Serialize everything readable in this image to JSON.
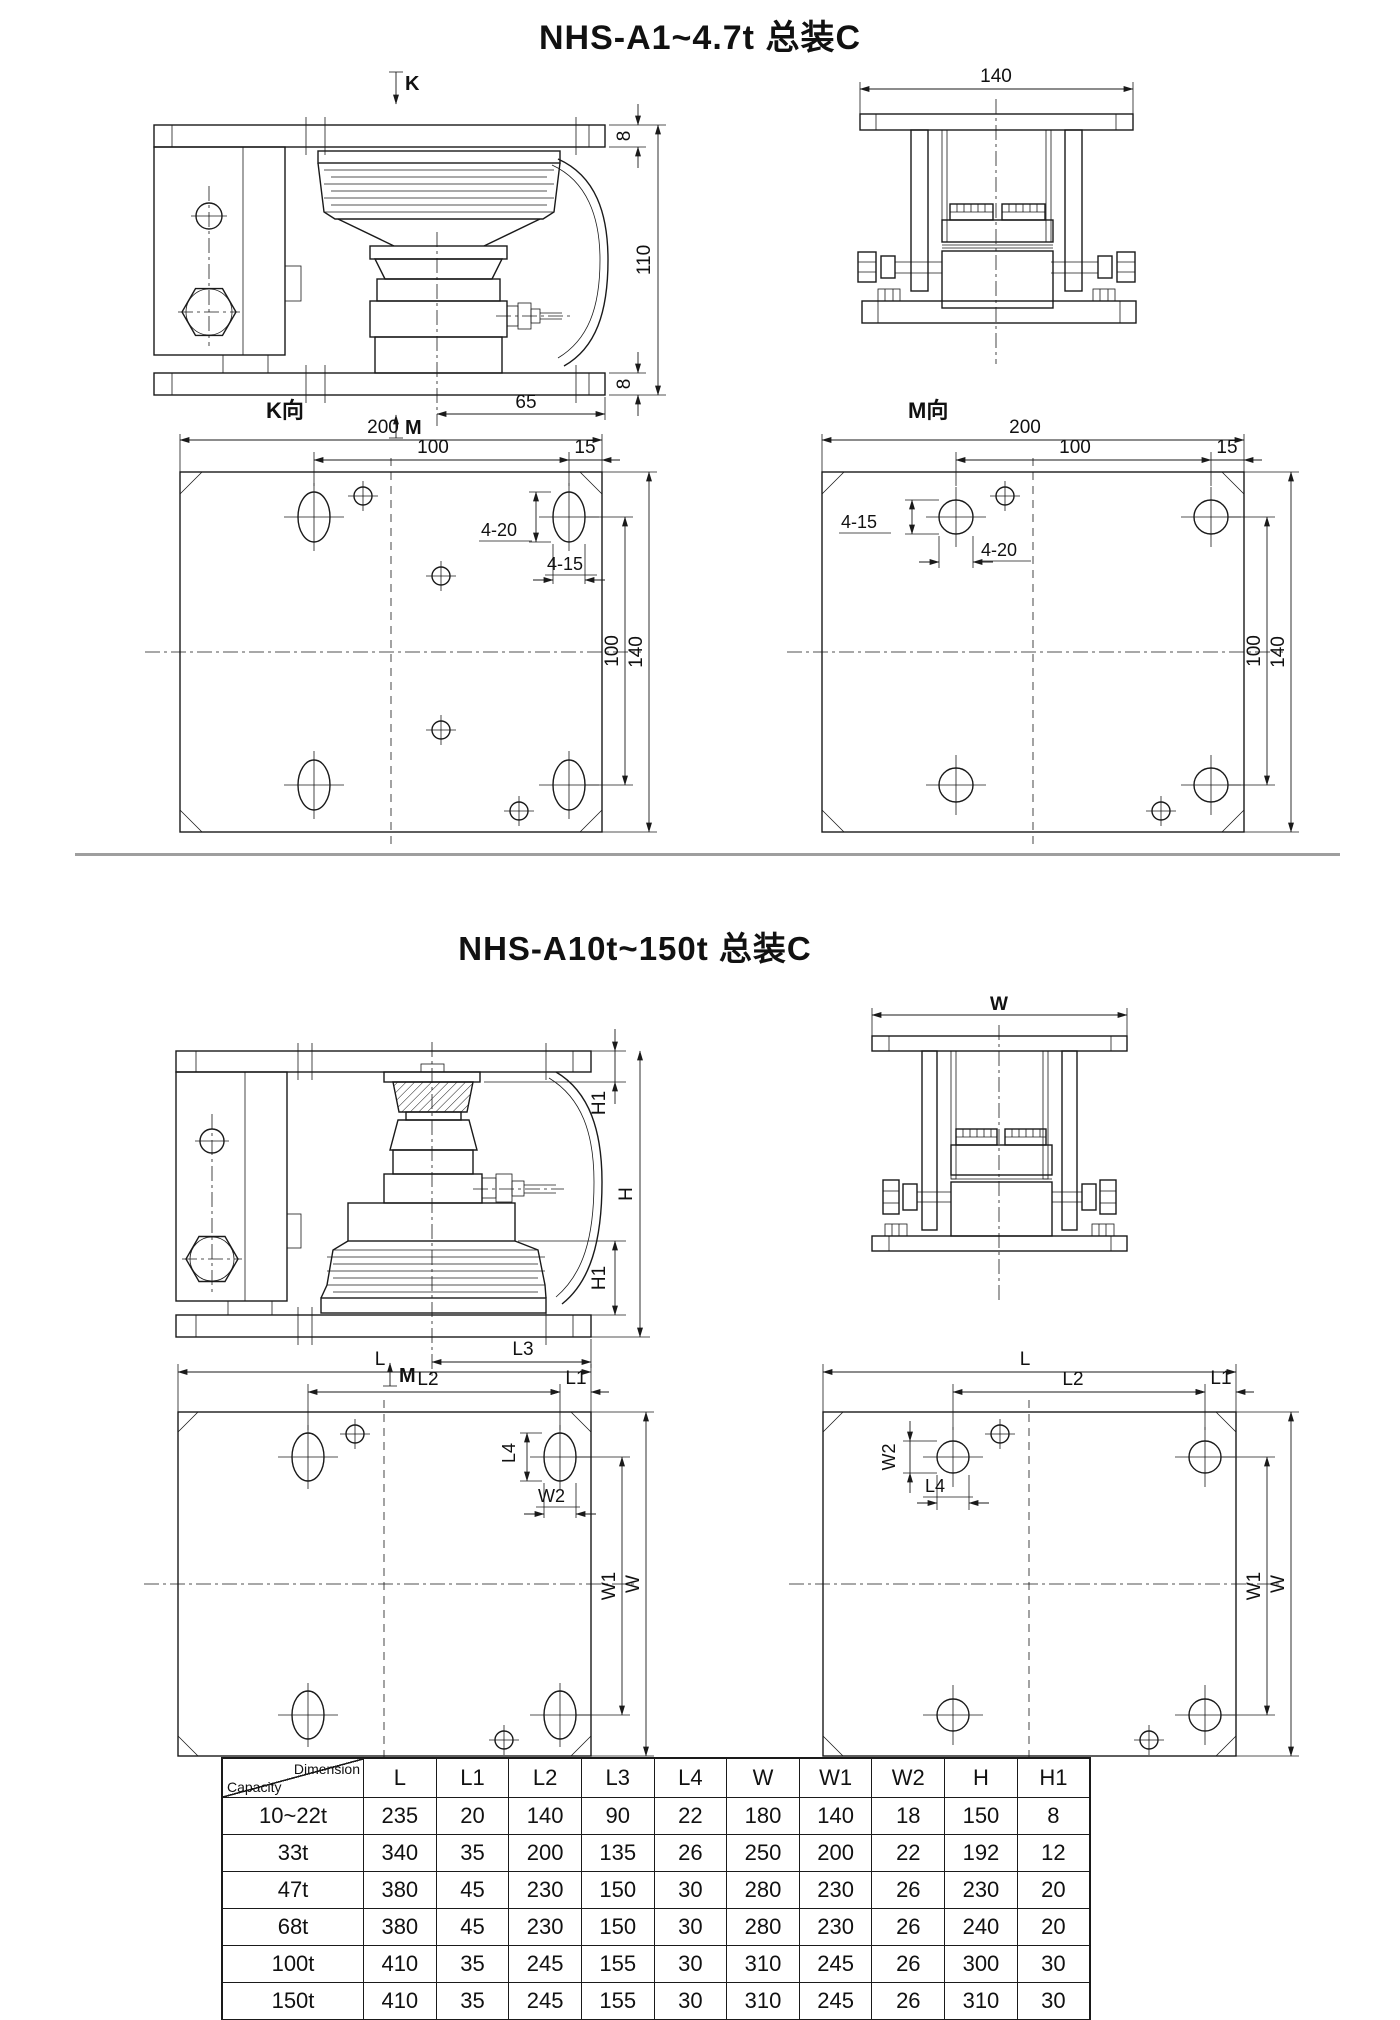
{
  "page": {
    "title1": "NHS-A1~4.7t 总装C",
    "title2": "NHS-A10t~150t 总装C",
    "line_color": "#1a1a1a",
    "divider_color": "#9e9e9e",
    "background": "#ffffff"
  },
  "section1": {
    "side_view": {
      "view_arrow_top": "K",
      "view_arrow_bottom": "M",
      "dim_plate_top": "8",
      "dim_height": "110",
      "dim_plate_bottom": "8",
      "dim_offset": "65"
    },
    "front_view": {
      "dim_width": "140"
    },
    "plan_top": {
      "label": "K向",
      "dim_width": "200",
      "dim_span": "100",
      "dim_edge": "15",
      "slot_dim": "4-20",
      "hole_dim": "4-15",
      "dim_span_v": "100",
      "dim_height": "140"
    },
    "plan_bottom": {
      "label": "M向",
      "dim_width": "200",
      "dim_span": "100",
      "dim_edge": "15",
      "hole_dim": "4-15",
      "slot_dim": "4-20",
      "dim_span_v": "100",
      "dim_height": "140"
    }
  },
  "section2": {
    "side_view": {
      "dim_h1_top": "H1",
      "dim_h": "H",
      "dim_h1_bottom": "H1",
      "dim_l3": "L3",
      "view_arrow_bottom": "M"
    },
    "front_view": {
      "dim_width": "W"
    },
    "plan_top": {
      "dim_l": "L",
      "dim_l2": "L2",
      "dim_l1": "L1",
      "dim_l4": "L4",
      "dim_w2": "W2",
      "dim_w1": "W1",
      "dim_w": "W"
    },
    "plan_bottom": {
      "dim_l": "L",
      "dim_l2": "L2",
      "dim_l1": "L1",
      "dim_w2": "W2",
      "dim_l4": "L4",
      "dim_w1": "W1",
      "dim_w": "W"
    }
  },
  "table": {
    "corner": {
      "top_right": "Dimension",
      "bottom_left": "Capacity"
    },
    "columns": [
      "L",
      "L1",
      "L2",
      "L3",
      "L4",
      "W",
      "W1",
      "W2",
      "H",
      "H1"
    ],
    "rows": [
      {
        "capacity": "10~22t",
        "values": [
          235,
          20,
          140,
          90,
          22,
          180,
          140,
          18,
          150,
          8
        ]
      },
      {
        "capacity": "33t",
        "values": [
          340,
          35,
          200,
          135,
          26,
          250,
          200,
          22,
          192,
          12
        ]
      },
      {
        "capacity": "47t",
        "values": [
          380,
          45,
          230,
          150,
          30,
          280,
          230,
          26,
          230,
          20
        ]
      },
      {
        "capacity": "68t",
        "values": [
          380,
          45,
          230,
          150,
          30,
          280,
          230,
          26,
          240,
          20
        ]
      },
      {
        "capacity": "100t",
        "values": [
          410,
          35,
          245,
          155,
          30,
          310,
          245,
          26,
          300,
          30
        ]
      },
      {
        "capacity": "150t",
        "values": [
          410,
          35,
          245,
          155,
          30,
          310,
          245,
          26,
          310,
          30
        ]
      }
    ]
  }
}
